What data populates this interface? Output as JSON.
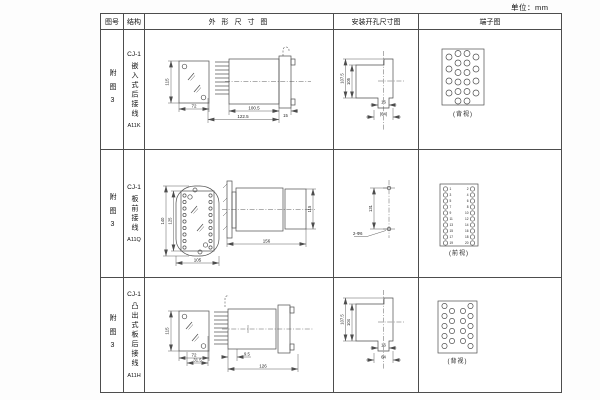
{
  "unit_label": "单位：mm",
  "colors": {
    "ink": "#4d4d4d",
    "text": "#222222"
  },
  "headers": {
    "fig_no": "图号",
    "structure": "结构",
    "outline": "外 形 尺 寸 图",
    "mounting": "安装开孔尺寸图",
    "terminal": "端子图"
  },
  "rows": [
    {
      "fig_no": "附图3",
      "model": "CJ-1",
      "type": "嵌入式后接线",
      "code": "A11K",
      "outline": {
        "front_h": "115",
        "front_w": "72",
        "body_len": "100.5",
        "total_len": "122.5",
        "flange_t": "15"
      },
      "mounting": {
        "height_outer": "107.5",
        "height_inner": "105",
        "slot_w": "16",
        "width": "(64)"
      },
      "terminal_label": "(背视)"
    },
    {
      "fig_no": "附图3",
      "model": "CJ-1",
      "type": "板前接线",
      "code": "A11Q",
      "outline": {
        "front_h_outer": "140",
        "front_h_inner": "125",
        "front_w": "105",
        "side_len": "156",
        "side_h": "115"
      },
      "mounting": {
        "hole_dist": "131",
        "hole_label": "2-Φ6"
      },
      "terminal_label": "(前视)",
      "terminal_numbers_left": [
        "1",
        "3",
        "5",
        "7",
        "9",
        "11",
        "13",
        "15",
        "17",
        "19"
      ],
      "terminal_numbers_right": [
        "2",
        "4",
        "6",
        "8",
        "10",
        "12",
        "14",
        "16",
        "18",
        "20"
      ]
    },
    {
      "fig_no": "附图3",
      "model": "CJ-1",
      "type": "凸出式板后接线",
      "code": "A11H",
      "outline": {
        "front_h": "115",
        "front_w": "72",
        "pin_len": "31.5",
        "gap": "9.5",
        "total_len": "126"
      },
      "mounting": {
        "height_outer": "107.5",
        "height_inner": "104",
        "slot_w": "16",
        "width": "64"
      },
      "terminal_label": "(背视)"
    }
  ]
}
